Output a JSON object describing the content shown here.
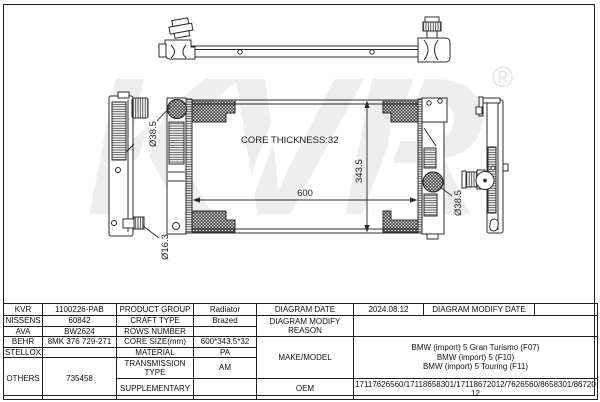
{
  "drawing": {
    "core_thickness_label": "CORE THICKNESS:32",
    "dim_core_width": "600",
    "dim_core_height": "343.5",
    "dim_inlet_diameter": "Ø38.5",
    "dim_outlet_diameter": "Ø38.5",
    "dim_drain_diameter": "Ø16.3",
    "watermark_text": "KVR",
    "watermark_registered": "®",
    "line_color": "#2b2b2b",
    "watermark_color": "#eeeeee"
  },
  "spec_table": {
    "cross_reference": {
      "kvr": {
        "label": "KVR",
        "value": "1100226-PAB"
      },
      "nissens": {
        "label": "NISSENS",
        "value": "60842"
      },
      "ava": {
        "label": "AVA",
        "value": "BW2624"
      },
      "behr": {
        "label": "BEHR",
        "value": "8MK 376 729-271"
      },
      "stellox": {
        "label": "STELLOX",
        "value": ""
      },
      "others": {
        "label": "OTHERS",
        "value": "735458"
      }
    },
    "attributes": {
      "product_group": {
        "label": "PRODUCT GROUP",
        "value": "Radiator"
      },
      "craft_type": {
        "label": "CRAFT TYPE",
        "value": "Brazed"
      },
      "rows_number": {
        "label": "ROWS NUMBER",
        "value": ""
      },
      "core_size": {
        "label": "CORE SIZE(mm)",
        "value": "600*343.5*32"
      },
      "material": {
        "label": "MATERIAL",
        "value": "PA"
      },
      "transmission_type": {
        "label": "TRANSMISSION TYPE",
        "value": "AM"
      },
      "supplementary": {
        "label": "SUPPLEMENTARY",
        "value": ""
      }
    },
    "diagram": {
      "diagram_date": {
        "label": "DIAGRAM DATE",
        "value": "2024.08.12"
      },
      "diagram_modify_date": {
        "label": "DIAGRAM MODIFY DATE",
        "value": ""
      },
      "diagram_modify_reason": {
        "label": "DIAGRAM MODIFY REASON",
        "value": ""
      },
      "make_model": {
        "label": "MAKE/MODEL",
        "lines": [
          "BMW (import) 5 Gran Turismo (F07)",
          "BMW (import) 5 (F10)",
          "BMW (import) 5 Touring (F11)"
        ]
      },
      "oem": {
        "label": "OEM",
        "value": "17117626560/17118658301/17118672012/7626560/8658301/8672012"
      }
    }
  }
}
